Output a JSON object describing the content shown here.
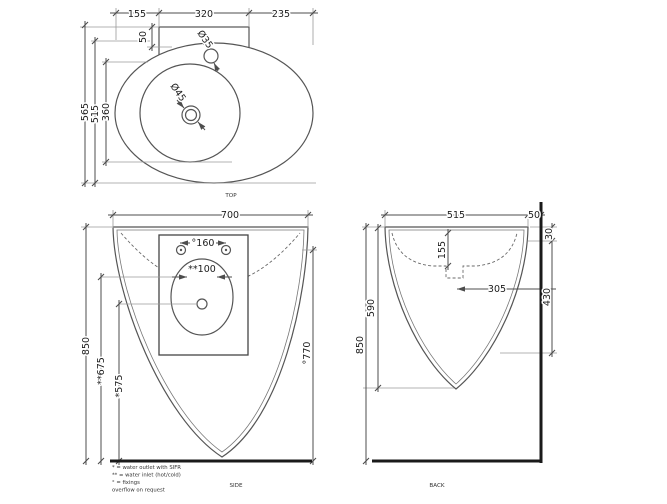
{
  "views": {
    "top": {
      "label": "TOP",
      "dims": {
        "w_left": "155",
        "w_center": "320",
        "w_right": "235",
        "deck_offset": "50",
        "faucet_hole": "Ø35",
        "drain_hole": "Ø45",
        "depth_total": "565",
        "depth_outer": "515",
        "depth_inner": "360"
      }
    },
    "side": {
      "label": "SIDE",
      "dims": {
        "width": "700",
        "fixing_spacing": "°160",
        "inlet_spacing": "**100",
        "height": "850",
        "inlet_height": "**675",
        "outlet_height": "*575",
        "fixing_height": "°770"
      }
    },
    "back": {
      "label": "BACK",
      "dims": {
        "width": "515",
        "wall_gap": "50",
        "rim_drop": "30",
        "bowl_depth": "155",
        "drain_to_wall": "305",
        "fixing_drop": "430",
        "body_height": "590",
        "height": "850"
      }
    }
  },
  "legend": {
    "lines": [
      "* = water outlet with SIFR",
      "** = water inlet (hot/cold)",
      "° = fixings",
      "overflow on request"
    ]
  },
  "colors": {
    "line": "#4d4d4d",
    "thick": "#1a1a1a",
    "extension": "#9a9a9a",
    "background": "#ffffff"
  }
}
